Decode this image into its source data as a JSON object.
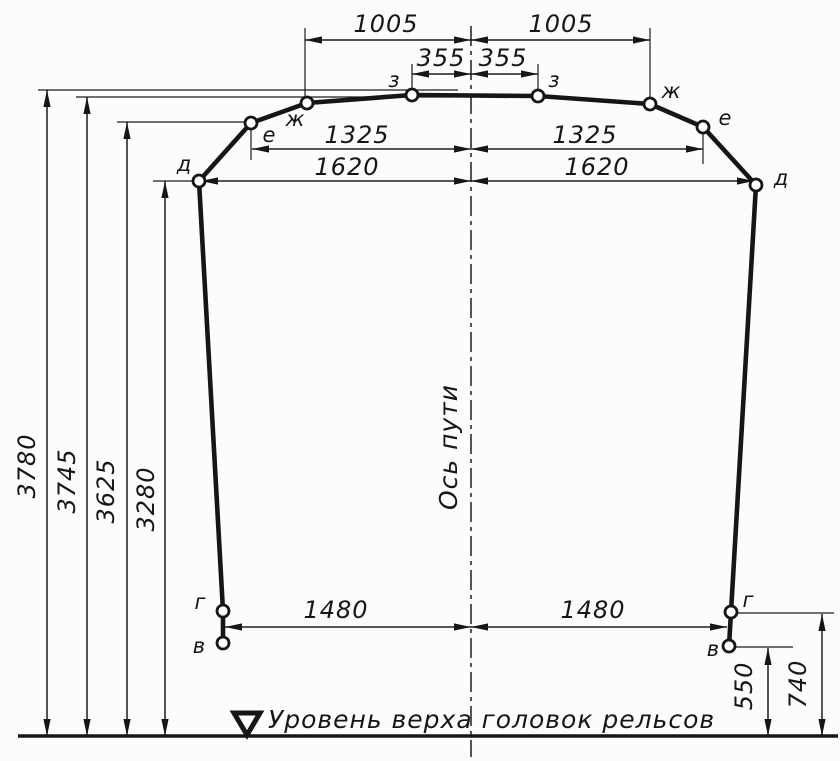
{
  "diagram": {
    "axis_label": "Ось пути",
    "rail_level_label": "Уровень верха головок рельсов",
    "points": {
      "v": "в",
      "g": "г",
      "d": "д",
      "e": "е",
      "zh": "ж",
      "z": "з"
    },
    "dims": {
      "d1005": "1005",
      "d355": "355",
      "d1325": "1325",
      "d1620": "1620",
      "d1480": "1480",
      "d3780": "3780",
      "d3745": "3745",
      "d3625": "3625",
      "d3280": "3280",
      "d550": "550",
      "d740": "740"
    },
    "colors": {
      "ink": "#161616",
      "paper": "#fcfcfa"
    }
  }
}
